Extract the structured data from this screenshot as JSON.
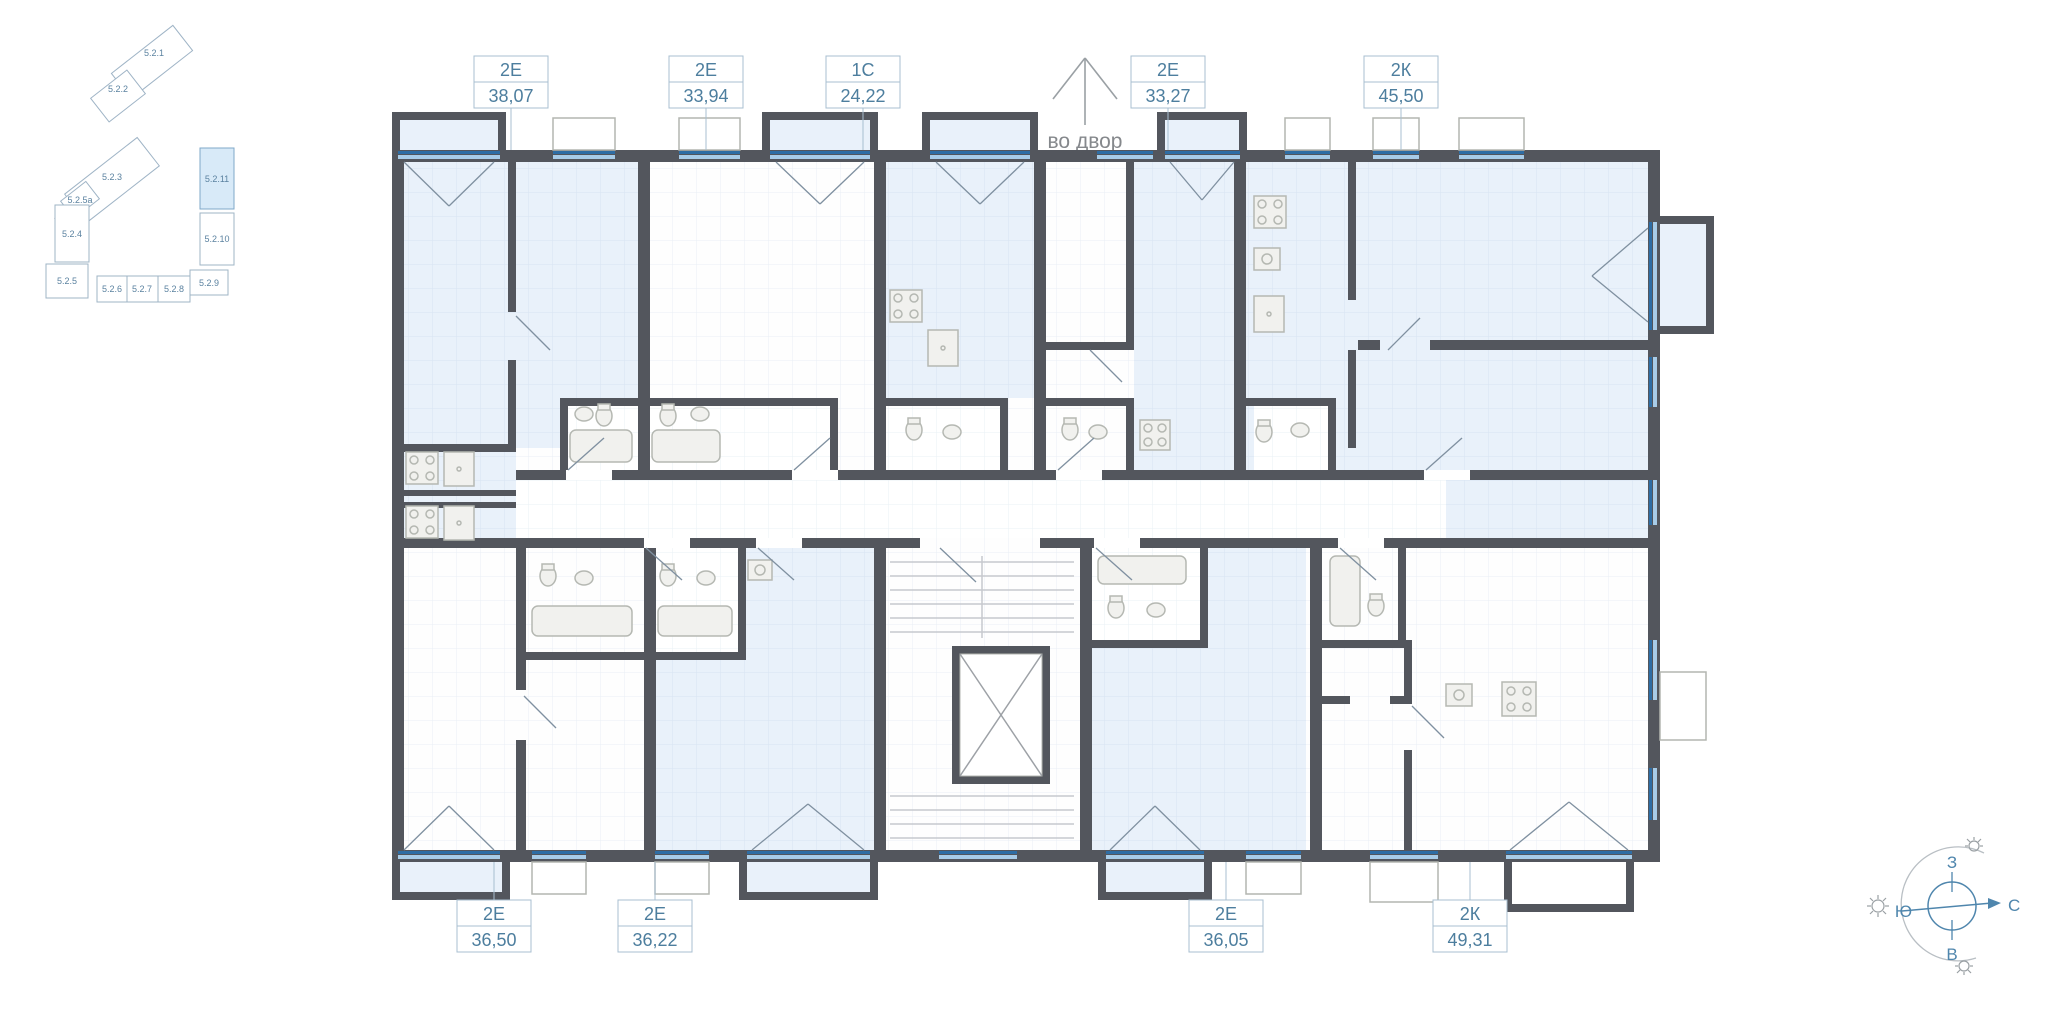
{
  "apartments": {
    "top": [
      {
        "type": "2Е",
        "area": "38,07"
      },
      {
        "type": "2Е",
        "area": "33,94"
      },
      {
        "type": "1С",
        "area": "24,22"
      },
      {
        "type": "2Е",
        "area": "33,27"
      },
      {
        "type": "2К",
        "area": "45,50"
      }
    ],
    "bottom": [
      {
        "type": "2Е",
        "area": "36,50"
      },
      {
        "type": "2Е",
        "area": "36,22"
      },
      {
        "type": "2Е",
        "area": "36,05"
      },
      {
        "type": "2К",
        "area": "49,31"
      }
    ]
  },
  "annotations": {
    "courtyard": "во двор"
  },
  "minimap": {
    "street": "ул. Амундсена",
    "highlighted": "5.2.11",
    "buildings": [
      "5.2.1",
      "5.2.2",
      "5.2.3",
      "5.2.5а",
      "5.2.4",
      "5.2.5",
      "5.2.6",
      "5.2.7",
      "5.2.8",
      "5.2.9",
      "5.2.10",
      "5.2.11"
    ]
  },
  "compass": {
    "west": "З",
    "north": "С",
    "south": "Ю",
    "east": "В"
  },
  "colors": {
    "wall": "#53565d",
    "room_blue": "#e9f1fa",
    "window": "#2e6da4",
    "accent_text": "#4d7e9e"
  }
}
